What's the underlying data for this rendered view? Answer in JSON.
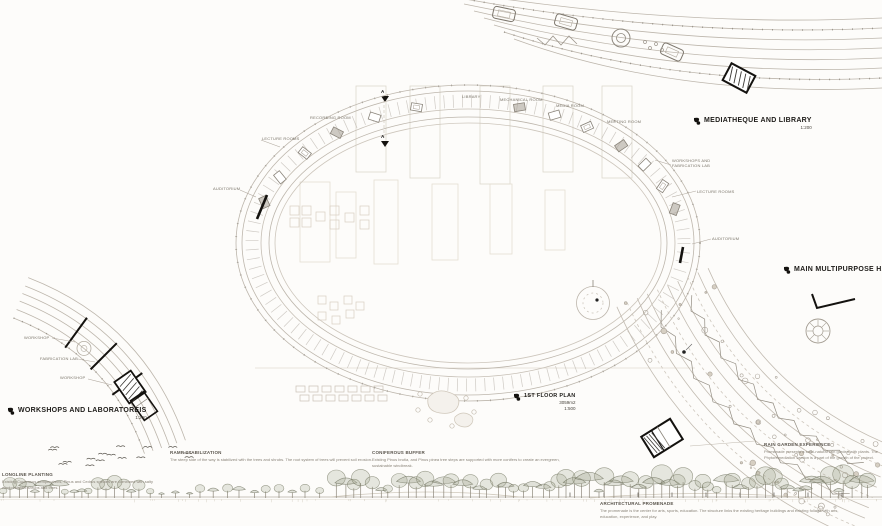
{
  "colors": {
    "line": "#bdb6ac",
    "line_dark": "#8a847a",
    "wall": "#14120f",
    "label": "#1e1c19",
    "muted": "#7b756a",
    "note_title": "#59544c",
    "note_body": "#8a8479",
    "foliage": "#9aa08c"
  },
  "main_plan": {
    "title": "1ST FLOOR PLAN",
    "area": "3059m2",
    "scale": "1:500",
    "section_marker": "A",
    "rooms": [
      {
        "label": "LECTURE ROOMS"
      },
      {
        "label": "RECORDING ROOM"
      },
      {
        "label": "LIBRARY"
      },
      {
        "label": "MECHANICAL ROOM"
      },
      {
        "label": "MEDIA ROOM"
      },
      {
        "label": "MEETING ROOM"
      },
      {
        "label": "WORKSHOPS AND FABRICATION LAB"
      },
      {
        "label": "LECTURE ROOMS"
      },
      {
        "label": "AUDITORIUM"
      },
      {
        "label": "AUDITORIUM"
      }
    ]
  },
  "detail_plans": [
    {
      "id": "mediatheque",
      "title": "MEDIATHEQUE AND LIBRARY",
      "scale": "1:200"
    },
    {
      "id": "multipurpose",
      "title": "MAIN MULTIPURPOSE HALL",
      "scale": "1:200"
    },
    {
      "id": "workshops",
      "title": "WORKSHOPS AND LABORATOREIS",
      "scale": "1:200",
      "rooms": [
        {
          "label": "WORKSHOP"
        },
        {
          "label": "FABRICATION LAB"
        },
        {
          "label": "WORKSHOP"
        }
      ]
    }
  ],
  "notes": [
    {
      "title": "LONGLINE PLANTING",
      "body": "Existing Cupressus sempervirens, Pinus and Cedrus species are combined with salty wind resistant shrubs and trees."
    },
    {
      "title": "RAMP STABILIZATION",
      "body": "The steep side of the way is stabilized with the trees and shrubs. The root system of trees will prevent soil erosion."
    },
    {
      "title": "CONIFEROUS BUFFER",
      "body": "Existing Pinus brutia, and Pinus pinea tree steps are supported with more conifers to create an evergreen, sustainable windbreak."
    },
    {
      "title": "RAIN GARDEN EXPERIENCE",
      "body": "Promenade presents a semi-natural rain garden with plants. The Phytoremediation section is a part of the growth of the project."
    },
    {
      "title": "ARCHITECTURAL PROMENADE",
      "body": "The promenade is the center for arts, sports, education. The structure links the existing heritage buildings and existing foliage with arts, education, experience, and play."
    }
  ]
}
